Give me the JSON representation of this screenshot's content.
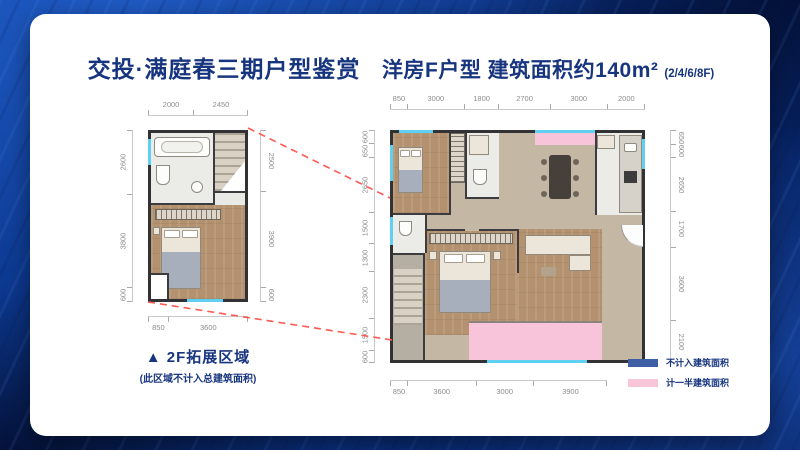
{
  "header": {
    "left_title": "交投·满庭春三期户型鉴赏",
    "right_title": "洋房F户型 建筑面积约140m²",
    "right_sub": "(2/4/6/8F)"
  },
  "small_plan": {
    "caption": "▲ 2F拓展区域",
    "caption_note": "(此区域不计入总建筑面积)",
    "dims": {
      "top": [
        "2000",
        "2450"
      ],
      "bottom": [
        "850",
        "3600"
      ],
      "left": [
        "2600",
        "3800",
        "600"
      ],
      "right": [
        "2500",
        "3900",
        "600"
      ]
    }
  },
  "big_plan": {
    "dims": {
      "top": [
        "850",
        "3000",
        "1800",
        "2700",
        "3000",
        "2000"
      ],
      "bottom": [
        "850",
        "3600",
        "3000",
        "3900"
      ],
      "left": [
        "600",
        "650",
        "2650",
        "1500",
        "1300",
        "2300",
        "1500",
        "600"
      ],
      "right": [
        "650",
        "600",
        "2650",
        "1700",
        "3600",
        "2100"
      ]
    }
  },
  "legend": {
    "items": [
      {
        "label": "不计入建筑面积",
        "color": "#3f5fa5"
      },
      {
        "label": "计一半建筑面积",
        "color": "#f9c6d9"
      }
    ]
  },
  "colors": {
    "accent_navy": "#17357f",
    "window_cyan": "#5fd0f2",
    "balcony_pink": "#f7c4da",
    "connector_red": "#ff5a52"
  }
}
